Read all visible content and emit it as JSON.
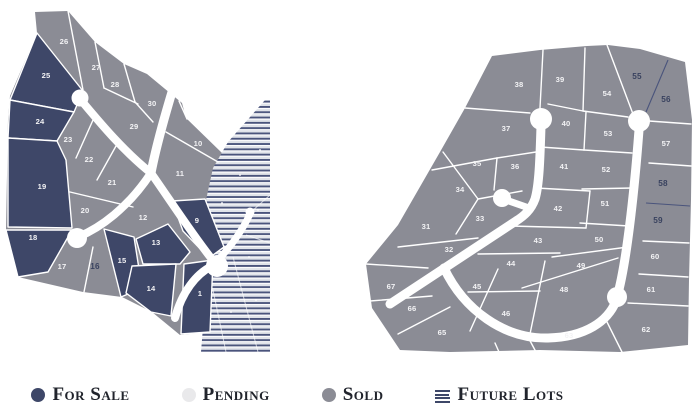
{
  "title": "Subdivision lot availability map",
  "colors": {
    "for_sale": "#3E4768",
    "pending": "#E9E9EB",
    "sold": "#8B8C95",
    "road": "#FFFFFF",
    "boundary_line": "#FFFFFF",
    "future_stripe_line": "#4A547C",
    "future_stripe_bg": "#E0E3E9",
    "lot_number": "#F3F3F5",
    "lot_number_dark": "#39425F"
  },
  "legend": {
    "items": [
      {
        "id": "for_sale",
        "label": "For Sale",
        "swatch": "dot",
        "color": "#3E4768"
      },
      {
        "id": "pending",
        "label": "Pending",
        "swatch": "dot",
        "color": "#E9E9EB"
      },
      {
        "id": "sold",
        "label": "Sold",
        "swatch": "dot",
        "color": "#8B8C95"
      },
      {
        "id": "future",
        "label": "Future Lots",
        "swatch": "stripes",
        "color": "#3E4768"
      }
    ]
  },
  "maps": {
    "left": {
      "name": "west-section",
      "lots": [
        {
          "number": "26",
          "status": "sold"
        },
        {
          "number": "27",
          "status": "sold"
        },
        {
          "number": "28",
          "status": "sold"
        },
        {
          "number": "30",
          "status": "sold"
        },
        {
          "number": "29",
          "status": "sold"
        },
        {
          "number": "25",
          "status": "for_sale"
        },
        {
          "number": "24",
          "status": "for_sale"
        },
        {
          "number": "23",
          "status": "sold"
        },
        {
          "number": "22",
          "status": "sold"
        },
        {
          "number": "21",
          "status": "sold"
        },
        {
          "number": "20",
          "status": "sold"
        },
        {
          "number": "19",
          "status": "for_sale"
        },
        {
          "number": "18",
          "status": "for_sale"
        },
        {
          "number": "17",
          "status": "sold"
        },
        {
          "number": "16",
          "status": "sold",
          "emphasis": true
        },
        {
          "number": "15",
          "status": "for_sale"
        },
        {
          "number": "13",
          "status": "for_sale"
        },
        {
          "number": "14",
          "status": "for_sale"
        },
        {
          "number": "12",
          "status": "sold"
        },
        {
          "number": "10",
          "status": "sold"
        },
        {
          "number": "11",
          "status": "sold"
        },
        {
          "number": "9",
          "status": "for_sale"
        },
        {
          "number": "1",
          "status": "for_sale"
        }
      ],
      "has_future_lots_area": true
    },
    "right": {
      "name": "east-section",
      "lots": [
        {
          "number": "31",
          "status": "sold"
        },
        {
          "number": "32",
          "status": "sold"
        },
        {
          "number": "33",
          "status": "sold"
        },
        {
          "number": "34",
          "status": "sold"
        },
        {
          "number": "35",
          "status": "sold"
        },
        {
          "number": "36",
          "status": "sold"
        },
        {
          "number": "37",
          "status": "sold"
        },
        {
          "number": "38",
          "status": "sold"
        },
        {
          "number": "39",
          "status": "sold"
        },
        {
          "number": "40",
          "status": "sold"
        },
        {
          "number": "41",
          "status": "sold"
        },
        {
          "number": "42",
          "status": "sold"
        },
        {
          "number": "43",
          "status": "sold"
        },
        {
          "number": "44",
          "status": "sold"
        },
        {
          "number": "45",
          "status": "sold"
        },
        {
          "number": "46",
          "status": "sold"
        },
        {
          "number": "48",
          "status": "sold"
        },
        {
          "number": "49",
          "status": "sold"
        },
        {
          "number": "50",
          "status": "sold"
        },
        {
          "number": "51",
          "status": "sold"
        },
        {
          "number": "52",
          "status": "sold"
        },
        {
          "number": "53",
          "status": "sold"
        },
        {
          "number": "54",
          "status": "sold"
        },
        {
          "number": "55",
          "status": "sold",
          "emphasis": true
        },
        {
          "number": "56",
          "status": "sold",
          "emphasis": true
        },
        {
          "number": "57",
          "status": "sold"
        },
        {
          "number": "58",
          "status": "sold",
          "emphasis": true
        },
        {
          "number": "59",
          "status": "sold",
          "emphasis": true
        },
        {
          "number": "60",
          "status": "sold"
        },
        {
          "number": "61",
          "status": "sold"
        },
        {
          "number": "62",
          "status": "sold"
        },
        {
          "number": "63",
          "status": "sold"
        },
        {
          "number": "65",
          "status": "sold"
        },
        {
          "number": "66",
          "status": "sold"
        },
        {
          "number": "67",
          "status": "sold"
        }
      ]
    }
  }
}
